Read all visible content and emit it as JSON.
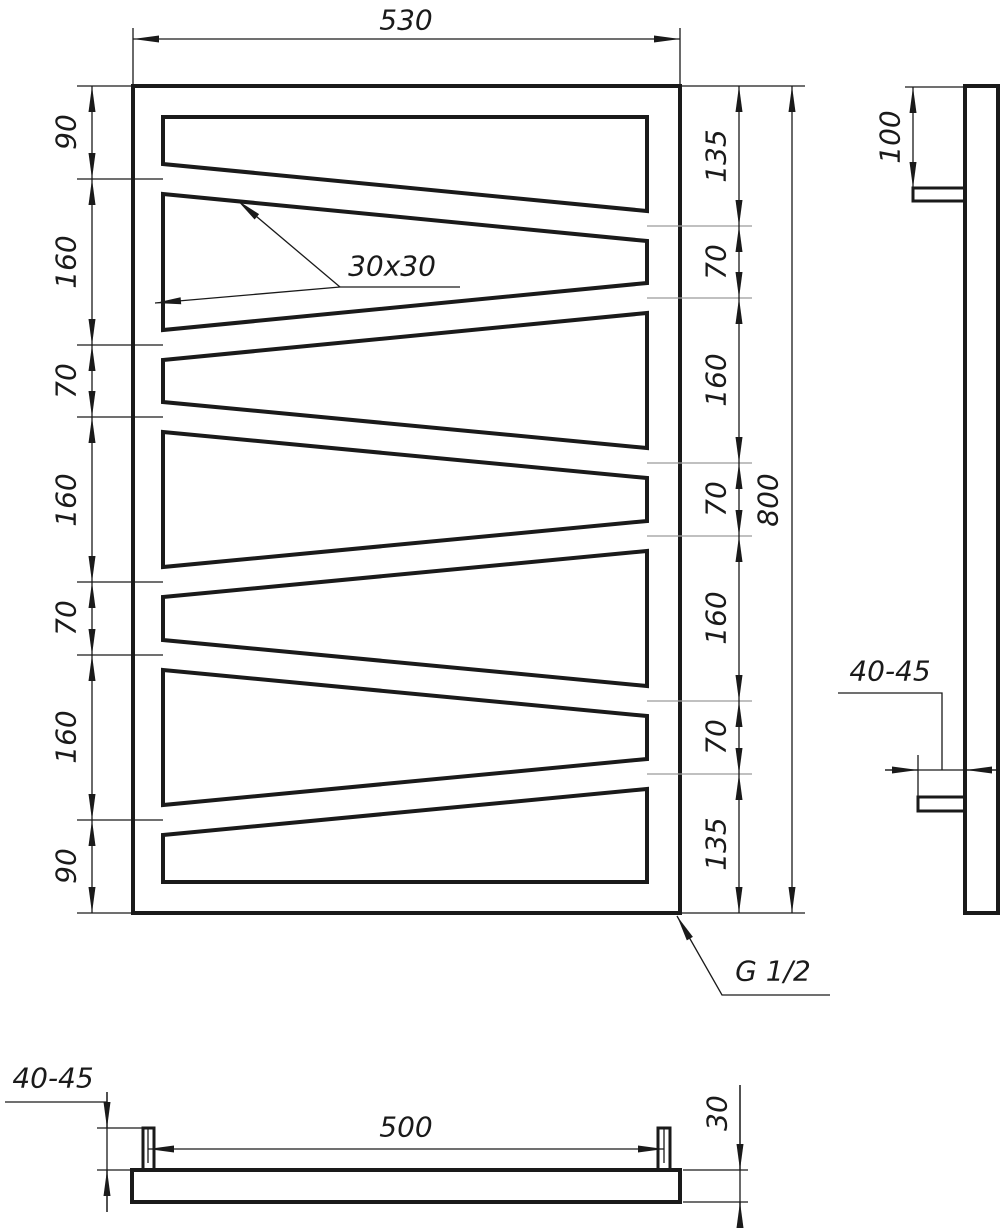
{
  "front_view": {
    "top_width": "530",
    "overall_height": "800",
    "left_chain": [
      "90",
      "160",
      "70",
      "160",
      "70",
      "160",
      "90"
    ],
    "right_chain": [
      "135",
      "70",
      "160",
      "70",
      "160",
      "70",
      "135"
    ],
    "tube_profile": "30x30",
    "thread_callout": "G 1/2"
  },
  "side_view": {
    "top_bracket_offset": "100",
    "wall_clearance": "40-45"
  },
  "bottom_view": {
    "bracket_spacing": "500",
    "wall_clearance": "40-45",
    "tube_depth": "30"
  }
}
